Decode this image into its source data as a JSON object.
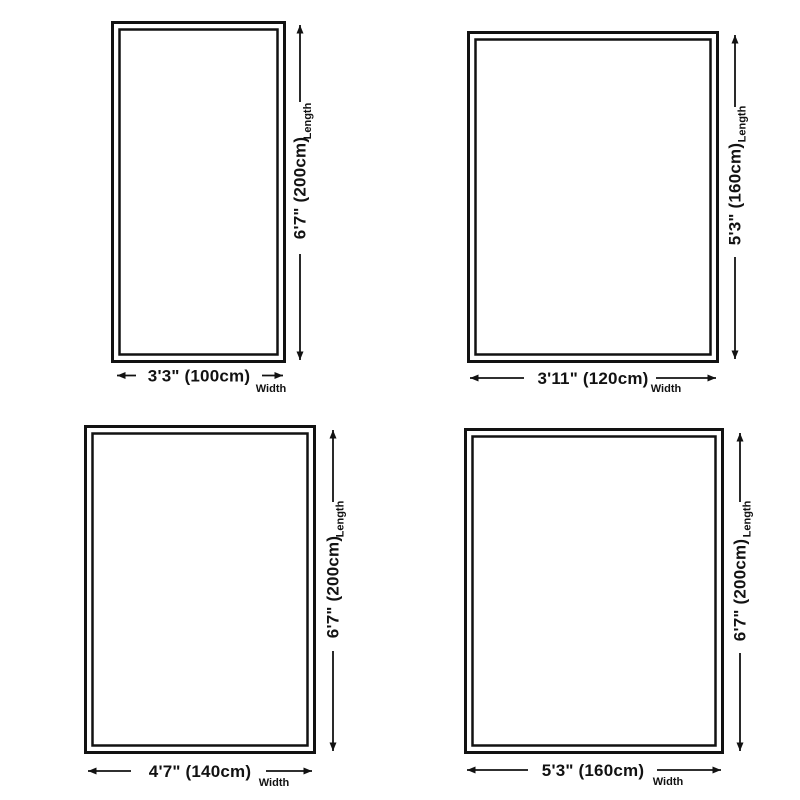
{
  "page": {
    "background_color": "#ffffff",
    "line_color": "#121212"
  },
  "diagrams": [
    {
      "width_label": "3'3\" (100cm)",
      "length_label": "6'7\" (200cm)",
      "width_caption": "Width",
      "length_caption": "Length",
      "width_cm": 100,
      "length_cm": 200
    },
    {
      "width_label": "3'11\" (120cm)",
      "length_label": "5'3\" (160cm)",
      "width_caption": "Width",
      "length_caption": "Length",
      "width_cm": 120,
      "length_cm": 160
    },
    {
      "width_label": "4'7\" (140cm)",
      "length_label": "6'7\" (200cm)",
      "width_caption": "Width",
      "length_caption": "Length",
      "width_cm": 140,
      "length_cm": 200
    },
    {
      "width_label": "5'3\" (160cm)",
      "length_label": "6'7\" (200cm)",
      "width_caption": "Width",
      "length_caption": "Length",
      "width_cm": 160,
      "length_cm": 200
    }
  ]
}
